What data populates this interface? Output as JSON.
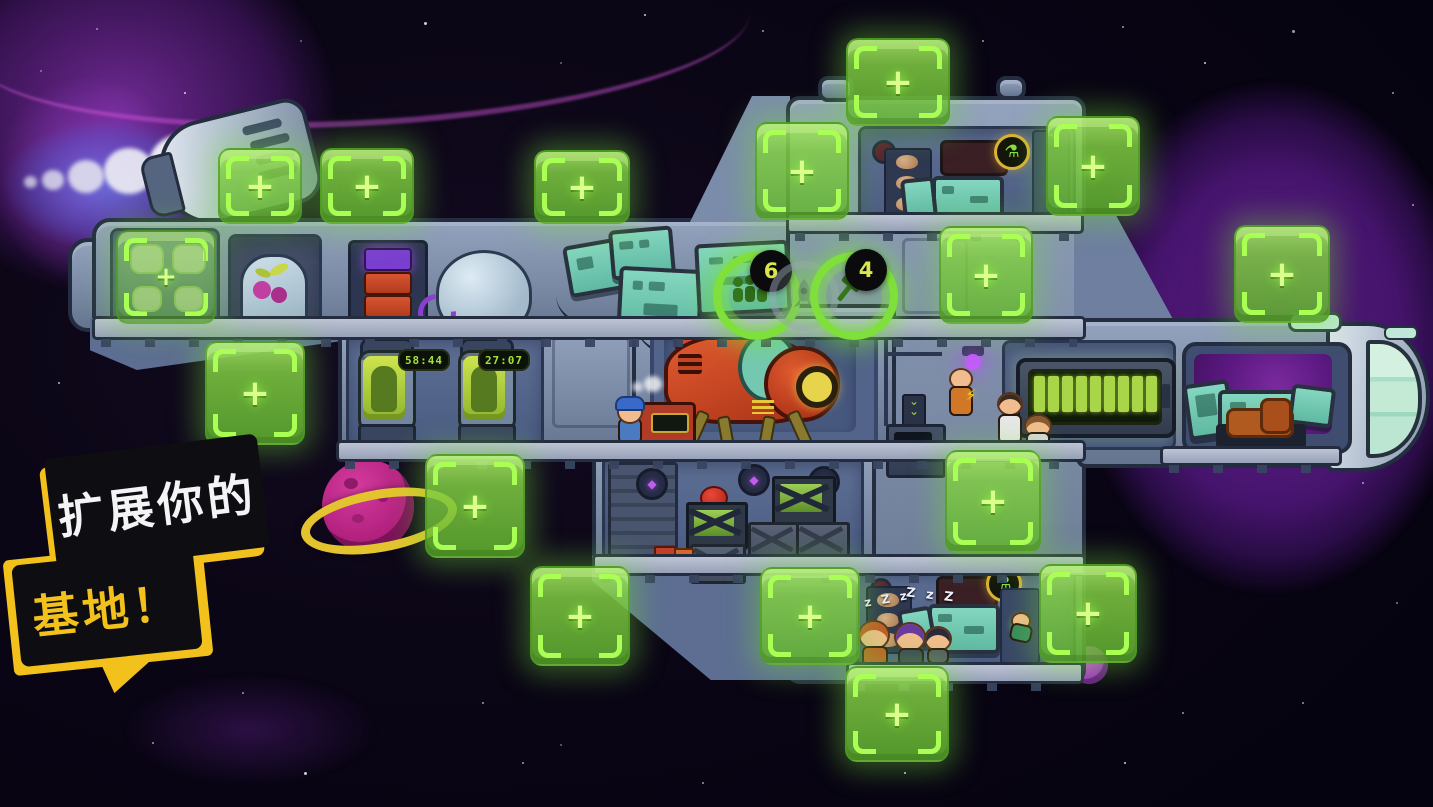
{
  "banner": {
    "line1": "扩展你的",
    "line2": "基地！"
  },
  "hud": {
    "crew_button": {
      "count": "6",
      "icon": "crew-icon"
    },
    "rocket_button": {
      "icon": "rocket-icon"
    },
    "build_button": {
      "count": "4",
      "icon": "hammer-icon"
    }
  },
  "incubators": [
    {
      "timer": "58:44"
    },
    {
      "timer": "27:07"
    }
  ],
  "sleep_text": {
    "left": "z Z z",
    "right": "Z z Z"
  },
  "battery": {
    "segments": 9
  },
  "tiles": {
    "plus": "+",
    "slots": [
      [
        846,
        38,
        100,
        84
      ],
      [
        755,
        122,
        90,
        94
      ],
      [
        1046,
        116,
        90,
        96
      ],
      [
        534,
        150,
        92,
        70
      ],
      [
        320,
        148,
        90,
        72
      ],
      [
        218,
        148,
        80,
        72
      ],
      [
        205,
        341,
        96,
        100
      ],
      [
        425,
        454,
        96,
        100
      ],
      [
        530,
        566,
        96,
        96
      ],
      [
        939,
        226,
        90,
        94
      ],
      [
        1234,
        225,
        92,
        94
      ],
      [
        945,
        450,
        92,
        99
      ],
      [
        1039,
        564,
        94,
        95
      ],
      [
        760,
        567,
        96,
        94
      ],
      [
        845,
        666,
        100,
        92
      ]
    ]
  },
  "glyphs": {
    "recycle": "♻",
    "flask": "⚗",
    "lightning": "⚡",
    "gem": "◆",
    "chevron_up": "⌃",
    "chevron_down": "⌄"
  },
  "colors": {
    "tile_green": "#7fd23f",
    "accent_green": "#a9d648",
    "badge_text": "#d8e84c",
    "banner_yellow": "#f2c11c",
    "nebula_purple": "#5c1b86",
    "hull_gray": "#7b8cab",
    "screen_teal": "#6fc7b2",
    "drill_orange": "#d0492a",
    "planet_magenta": "#c12a8c"
  }
}
